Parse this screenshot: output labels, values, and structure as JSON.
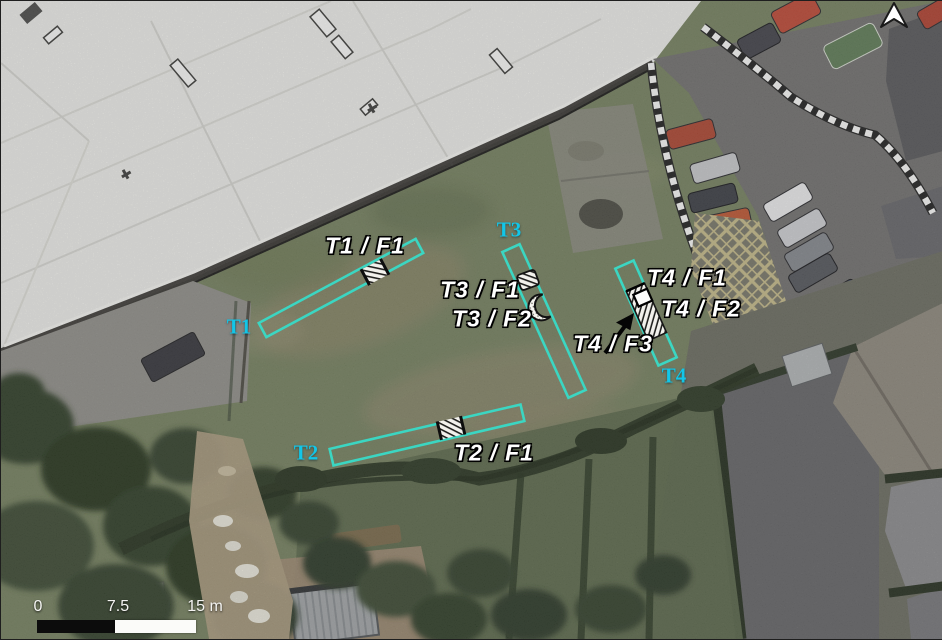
{
  "figure": {
    "description": "Aerial photograph with archaeological trench and feature locations",
    "colors": {
      "trench_outline": "#3BD6C2",
      "trench_label": "#12C6E8",
      "feature_label": "#FFFFFF",
      "label_halo": "#000000",
      "scale_text": "#F4F4F2"
    }
  },
  "trenches": {
    "t1": {
      "label": "T1"
    },
    "t2": {
      "label": "T2"
    },
    "t3": {
      "label": "T3"
    },
    "t4": {
      "label": "T4"
    }
  },
  "features": {
    "t1f1": {
      "label": "T1 / F1"
    },
    "t2f1": {
      "label": "T2 / F1"
    },
    "t3f1": {
      "label": "T3 / F1"
    },
    "t3f2": {
      "label": "T3 / F2"
    },
    "t4f1": {
      "label": "T4 / F1"
    },
    "t4f2": {
      "label": "T4 / F2"
    },
    "t4f3": {
      "label": "T4 / F3"
    }
  },
  "scale_bar": {
    "tick_start": "0",
    "tick_mid": "7.5",
    "tick_end": "15 m"
  }
}
